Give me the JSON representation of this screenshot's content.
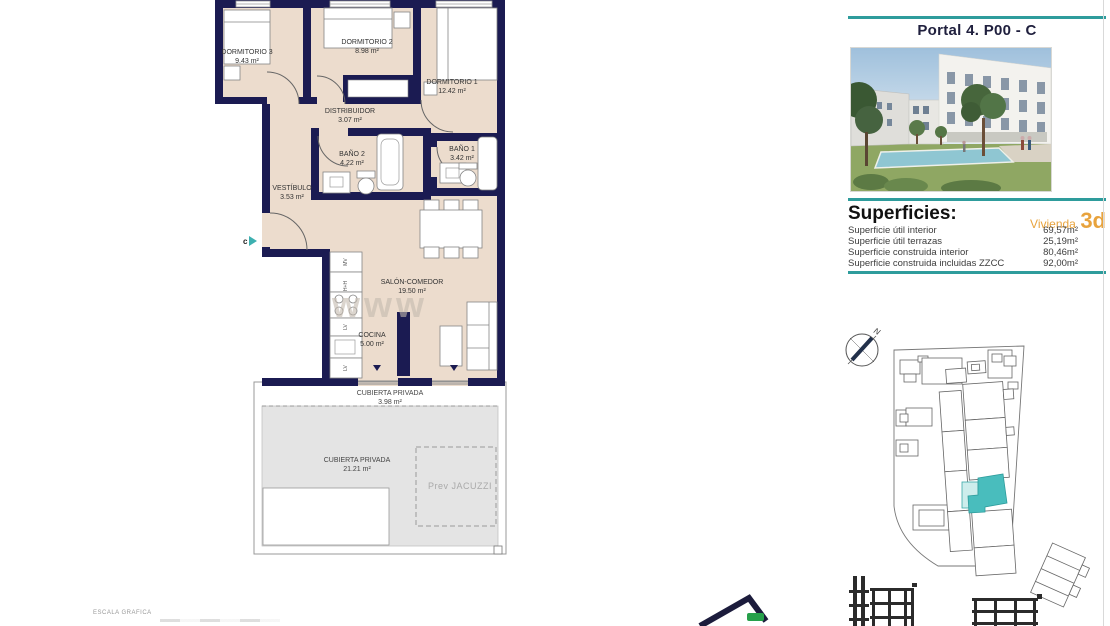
{
  "header": {
    "title": "Portal 4. P00 - C"
  },
  "accent_colors": {
    "teal": "#2E9C9C",
    "orange": "#E8A33D",
    "wall_navy": "#1B1B52",
    "floor_beige": "#ECDCCD",
    "terrace_gray": "#E4E4E4",
    "unit_highlight": "#49BDBD"
  },
  "superficies": {
    "heading": "Superficies:",
    "vivienda_label": "Vivienda",
    "vivienda_code": "3d",
    "rows": [
      {
        "label": "Superficie útil interior",
        "value": "69,57m²"
      },
      {
        "label": "Superficie útil terrazas",
        "value": "25,19m²"
      },
      {
        "label": "Superficie construida interior",
        "value": "80,46m²"
      },
      {
        "label": "Superficie construida incluidas ZZCC",
        "value": "92,00m²"
      }
    ]
  },
  "floorplan": {
    "watermark": "www",
    "entrance_label": "c",
    "rooms": [
      {
        "name": "DORMITORIO 3",
        "area": "9.43 m²"
      },
      {
        "name": "DORMITORIO 2",
        "area": "8.98 m²"
      },
      {
        "name": "DORMITORIO 1",
        "area": "12.42 m²"
      },
      {
        "name": "DISTRIBUIDOR",
        "area": "3.07 m²"
      },
      {
        "name": "BAÑO 2",
        "area": "4.22 m²"
      },
      {
        "name": "BAÑO 1",
        "area": "3.42 m²"
      },
      {
        "name": "VESTÍBULO",
        "area": "3.53 m²"
      },
      {
        "name": "SALÓN-COMEDOR",
        "area": "19.50 m²"
      },
      {
        "name": "COCINA",
        "area": "5.00 m²"
      },
      {
        "name": "CUBIERTA PRIVADA",
        "area": "3.98 m²"
      },
      {
        "name": "CUBIERTA PRIVADA",
        "area": "21.21 m²"
      }
    ],
    "jacuzzi_label": "Prev JACUZZI",
    "kitchen_units": [
      "MV",
      "H+H",
      "LV",
      "LV"
    ]
  },
  "compass": {
    "north_label": "N"
  },
  "footer": {
    "scale_label": "ESCALA GRAFICA"
  }
}
